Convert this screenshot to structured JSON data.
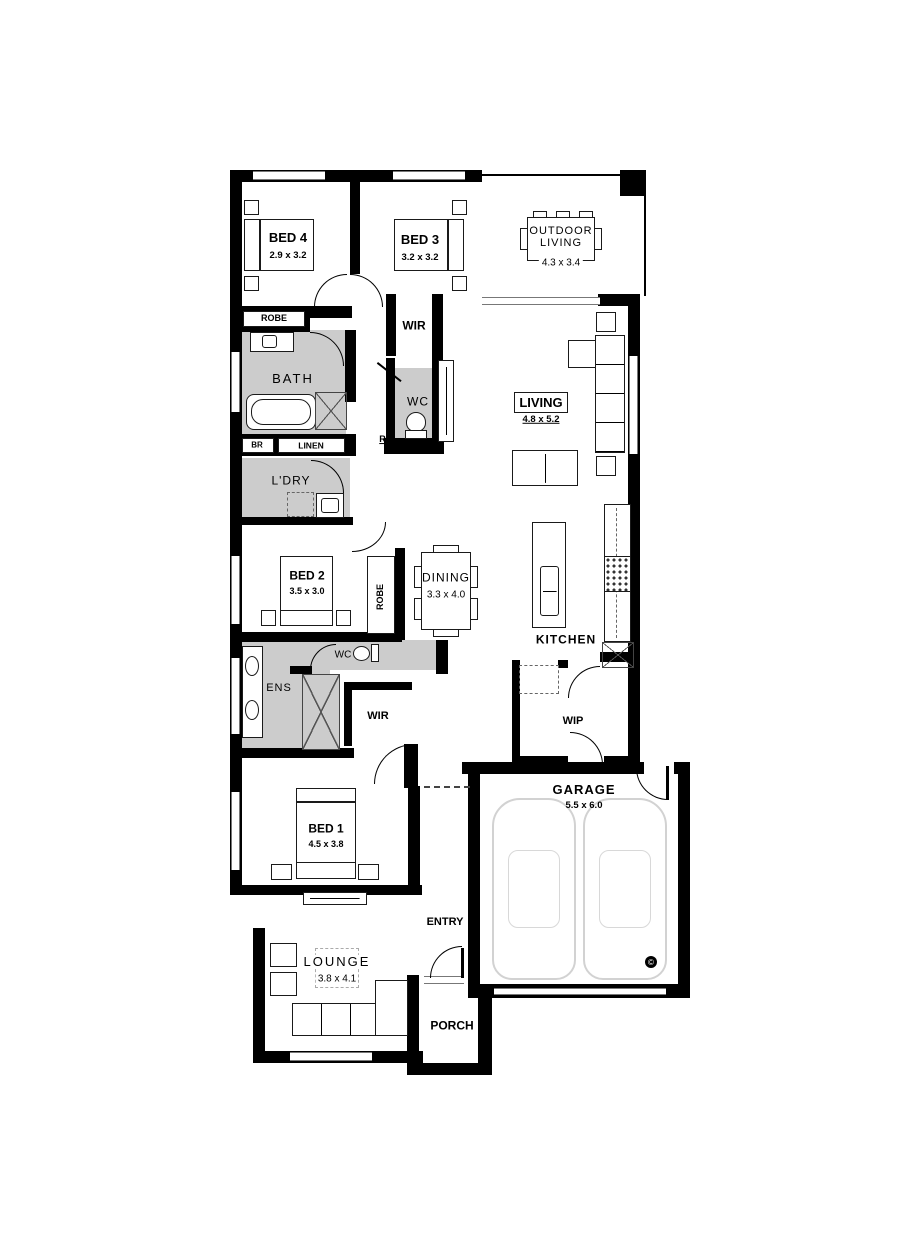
{
  "plan": {
    "colors": {
      "wall": "#000000",
      "wet_area": "#cccccc",
      "car_outline": "#d2d2d2",
      "window": "#777777"
    },
    "copyright": "©",
    "rooms": {
      "bed4": {
        "name": "BED 4",
        "dims": "2.9 x 3.2"
      },
      "bed3": {
        "name": "BED 3",
        "dims": "3.2 x 3.2"
      },
      "outdoor_living": {
        "name_line1": "OUTDOOR",
        "name_line2": "LIVING",
        "dims": "4.3 x 3.4"
      },
      "living": {
        "name": "LIVING",
        "dims": "4.8 x 5.2"
      },
      "dining": {
        "name": "DINING",
        "dims": "3.3 x 4.0"
      },
      "kitchen": {
        "name": "KITCHEN"
      },
      "bath": {
        "name": "BATH"
      },
      "ldry": {
        "name": "L'DRY"
      },
      "bed2": {
        "name": "BED 2",
        "dims": "3.5 x 3.0"
      },
      "ens": {
        "name": "ENS"
      },
      "bed1": {
        "name": "BED 1",
        "dims": "4.5 x 3.8"
      },
      "lounge": {
        "name": "LOUNGE",
        "dims": "3.8 x 4.1"
      },
      "garage": {
        "name": "GARAGE",
        "dims": "5.5 x 6.0"
      },
      "porch": {
        "name": "PORCH"
      },
      "entry": {
        "name": "ENTRY"
      },
      "wip": {
        "name": "WIP"
      },
      "wir_hall": {
        "name": "WIR"
      },
      "wir_master": {
        "name": "WIR"
      },
      "wc_hall": {
        "name": "WC"
      },
      "wc_ens": {
        "name": "WC"
      },
      "robe_hall": {
        "name": "ROBE"
      },
      "robe_bed2": {
        "name": "ROBE"
      },
      "br": {
        "name": "BR"
      },
      "linen": {
        "name": "LINEN"
      },
      "return_air": {
        "name": "R/A"
      }
    }
  }
}
